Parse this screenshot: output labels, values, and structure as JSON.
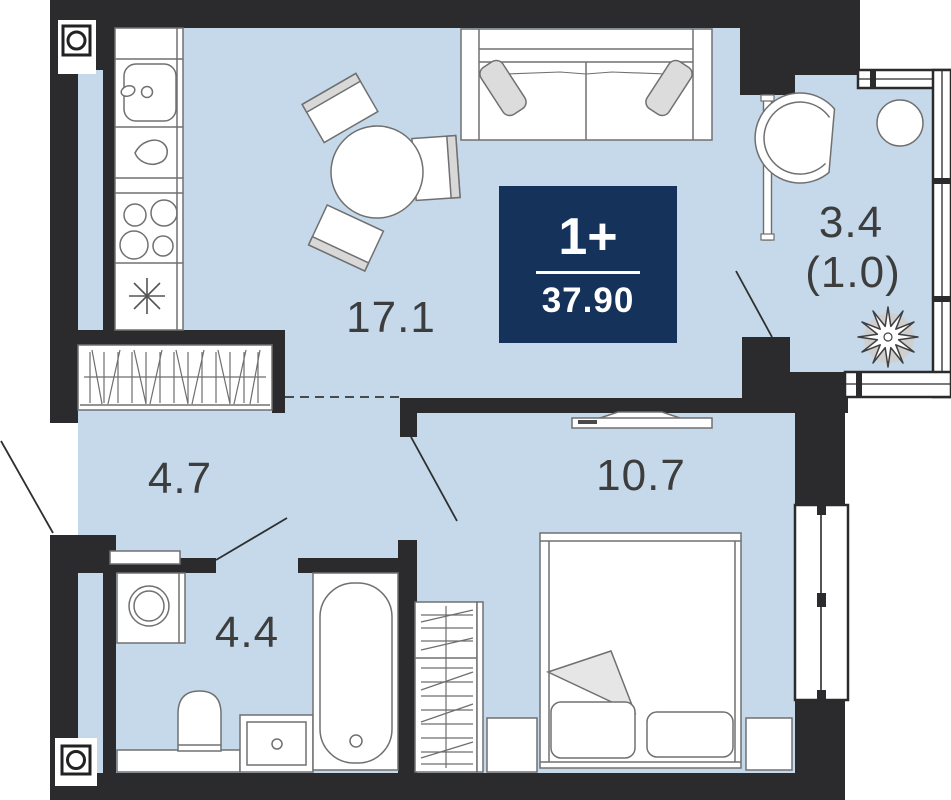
{
  "plan": {
    "badge": {
      "rooms_label": "1+",
      "total_area": "37.90"
    },
    "rooms": {
      "living_kitchen": {
        "area": "17.1"
      },
      "hallway": {
        "area": "4.7"
      },
      "bathroom": {
        "area": "4.4"
      },
      "bedroom": {
        "area": "10.7"
      },
      "balcony": {
        "area": "3.4",
        "reduced_area": "(1.0)"
      }
    },
    "colors": {
      "floor": "#c5d9ea",
      "walls": "#2b2a2c",
      "badge_bg": "#15325a",
      "label_text": "#3d3d3d",
      "furniture_outline": "#707070"
    }
  }
}
